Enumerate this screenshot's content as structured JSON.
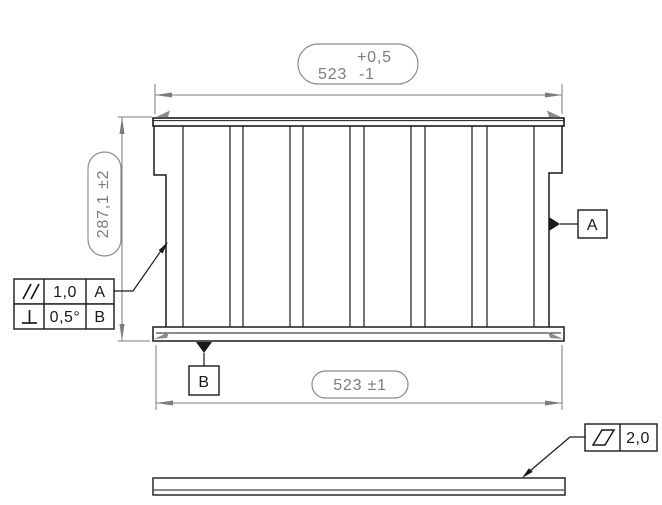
{
  "dimensions": {
    "top": {
      "value": "523",
      "tol_upper": "+0,5",
      "tol_lower": "-1"
    },
    "left": {
      "text": "287,1 ±2"
    },
    "bottom": {
      "text": "523 ±1"
    }
  },
  "feature_control_frames": {
    "parallelism": {
      "symbol_icon": "parallelism-icon",
      "tolerance": "1,0",
      "datum_ref": "A"
    },
    "perpendicularity": {
      "symbol_icon": "perpendicularity-icon",
      "tolerance": "0,5°",
      "datum_ref": "B"
    },
    "flatness": {
      "symbol_icon": "flatness-icon",
      "tolerance": "2,0"
    }
  },
  "datum_labels": {
    "a": "A",
    "b": "B"
  },
  "colors": {
    "part_line": "#1a1a1a",
    "dimension_gray": "#7b7b80",
    "background": "#ffffff"
  }
}
